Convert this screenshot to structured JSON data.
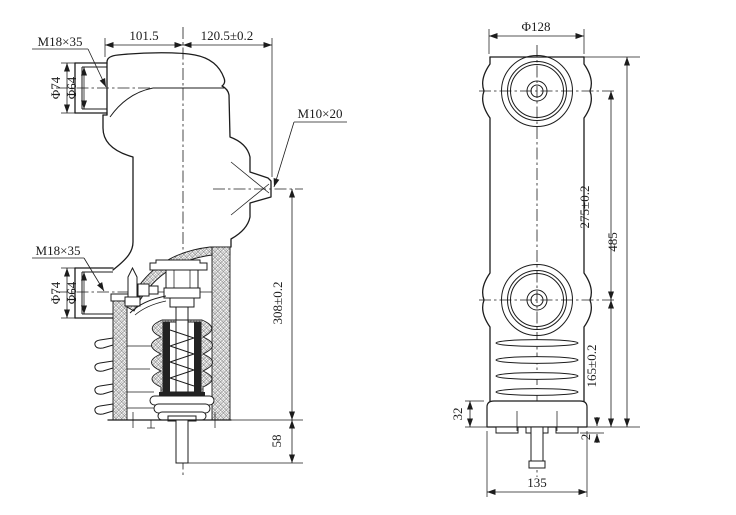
{
  "meta": {
    "paper_color": "#ffffff",
    "ink_color": "#1c1c1c"
  },
  "side_view": {
    "dim_width_left": "101.5",
    "dim_width_right": "120.5±0.2",
    "thread_upper": "M18×35",
    "thread_lower": "M18×35",
    "thread_side": "M10×20",
    "dia_outer_upper": "Φ74",
    "dia_inner_upper": "Φ64",
    "dia_outer_lower": "Φ74",
    "dia_inner_lower": "Φ64",
    "dim_height": "308±0.2",
    "dim_stem": "58"
  },
  "front_view": {
    "dia_top": "Φ128",
    "dim_centers": "275±0.2",
    "dim_total_height": "485",
    "dim_lower_section": "165±0.2",
    "dim_flange_height": "32",
    "dim_foot_step": "2",
    "dim_base_width": "135"
  }
}
